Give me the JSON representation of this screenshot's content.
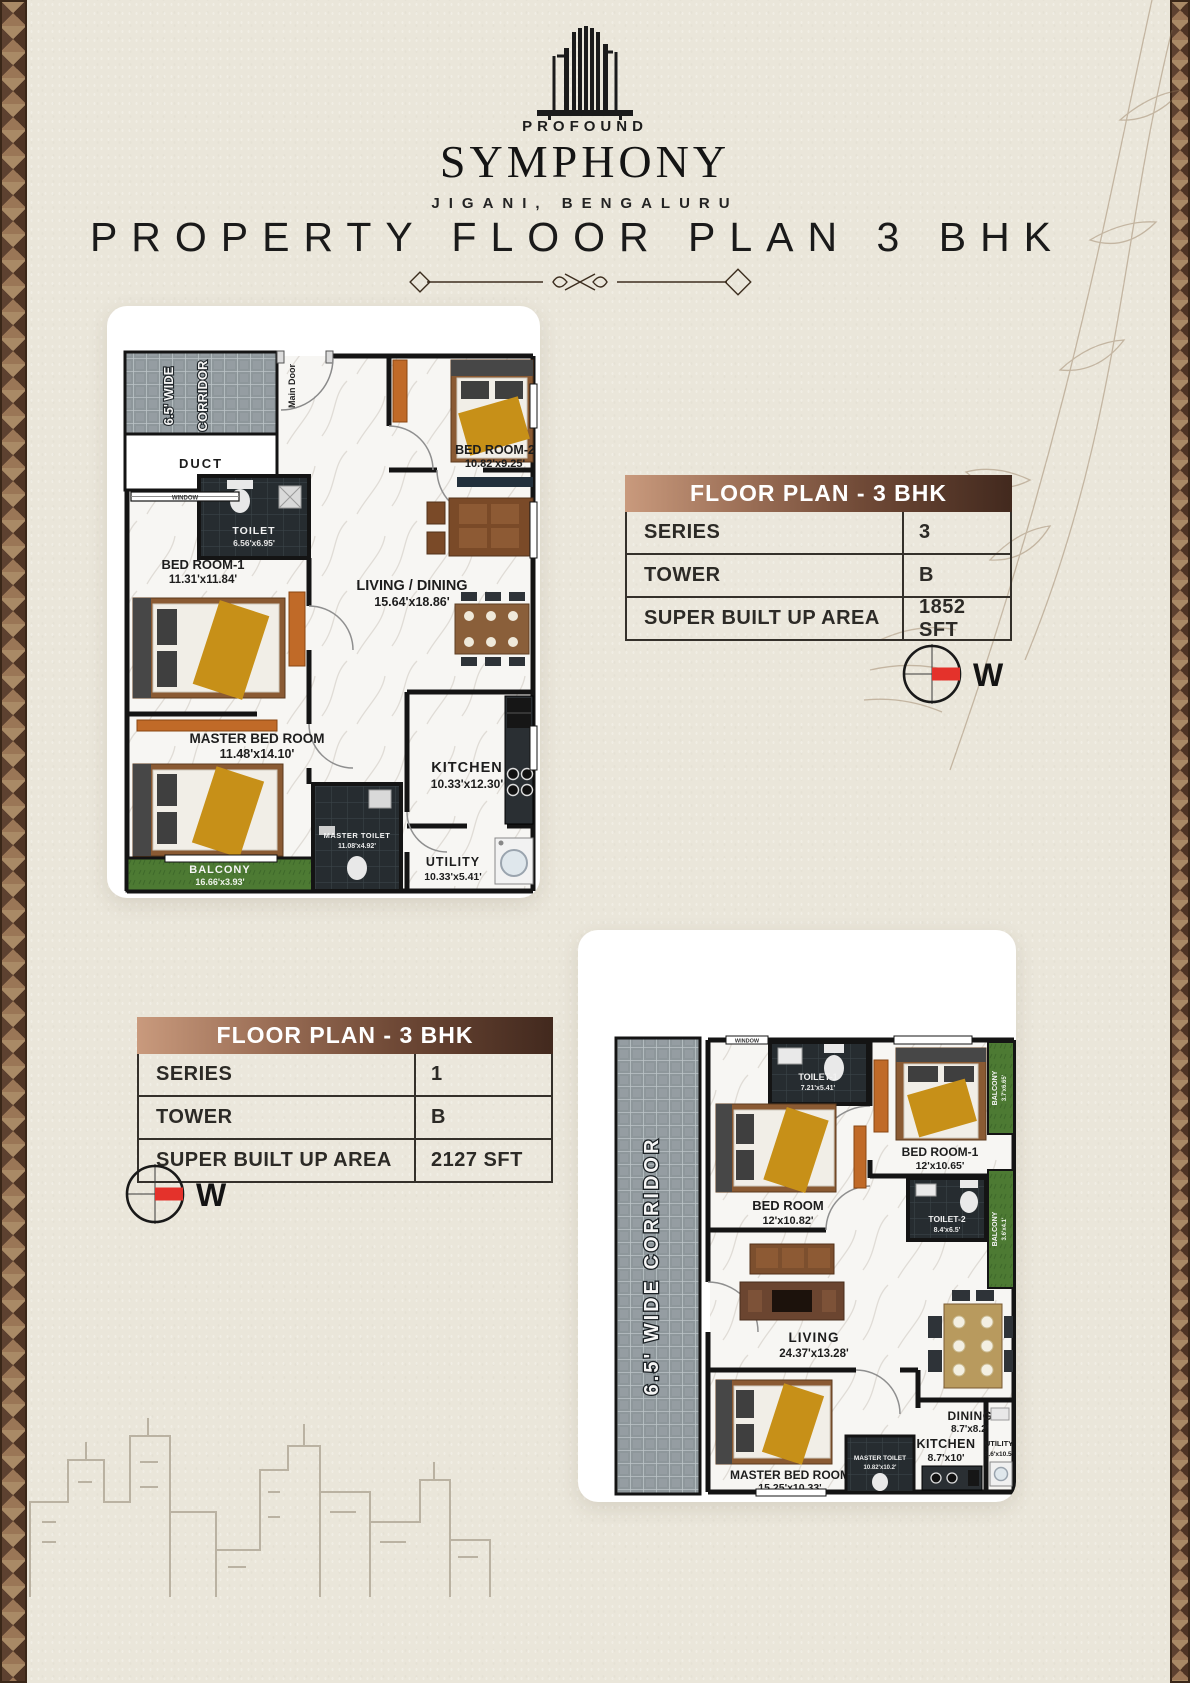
{
  "brand": {
    "top": "PROFOUND",
    "name": "SYMPHONY",
    "location": "JIGANI, BENGALURU"
  },
  "page_title": "PROPERTY FLOOR PLAN 3 BHK",
  "compass": {
    "west": "W"
  },
  "tables": {
    "plan_a": {
      "header": "FLOOR PLAN - 3 BHK",
      "rows": [
        {
          "label": "SERIES",
          "value": "3"
        },
        {
          "label": "TOWER",
          "value": "B"
        },
        {
          "label": "SUPER BUILT UP AREA",
          "value": "1852 SFT"
        }
      ]
    },
    "plan_b": {
      "header": "FLOOR PLAN - 3 BHK",
      "rows": [
        {
          "label": "SERIES",
          "value": "1"
        },
        {
          "label": "TOWER",
          "value": "B"
        },
        {
          "label": "SUPER BUILT UP AREA",
          "value": "2127 SFT"
        }
      ]
    }
  },
  "plan_a": {
    "corridor_line1": "6.5' WIDE",
    "corridor_line2": "CORRIDOR",
    "main_door": "Main Door",
    "duct": "DUCT",
    "window": "WINDOW",
    "rooms": {
      "bedroom2": {
        "name": "BED ROOM-2",
        "dim": "10.82'x9.25'"
      },
      "toilet": {
        "name": "TOILET",
        "dim": "6.56'x6.95'"
      },
      "bedroom1": {
        "name": "BED ROOM-1",
        "dim": "11.31'x11.84'"
      },
      "living": {
        "name": "LIVING / DINING",
        "dim": "15.64'x18.86'"
      },
      "master_bedroom": {
        "name": "MASTER BED ROOM",
        "dim": "11.48'x14.10'"
      },
      "kitchen": {
        "name": "KITCHEN",
        "dim": "10.33'x12.30'"
      },
      "master_toilet": {
        "name": "MASTER TOILET",
        "dim": "11.08'x4.92'"
      },
      "utility": {
        "name": "UTILITY",
        "dim": "10.33'x5.41'"
      },
      "balcony": {
        "name": "BALCONY",
        "dim": "16.66'x3.93'"
      }
    }
  },
  "plan_b": {
    "corridor": "6.5' WIDE CORRIDOR",
    "window": "WINDOW",
    "rooms": {
      "toilet1": {
        "name": "TOILET-1",
        "dim": "7.21'x5.41'"
      },
      "bedroom1": {
        "name": "BED ROOM-1",
        "dim": "12'x10.65'"
      },
      "balcony1": {
        "name": "BALCONY",
        "dim": "3.7'x6.65'"
      },
      "bedroom": {
        "name": "BED ROOM",
        "dim": "12'x10.82'"
      },
      "toilet2": {
        "name": "TOILET-2",
        "dim": "8.4'x6.5'"
      },
      "balcony2": {
        "name": "BALCONY",
        "dim": "3.6'x4.1'"
      },
      "living": {
        "name": "LIVING",
        "dim": "24.37'x13.28'"
      },
      "dining": {
        "name": "DINING",
        "dim": "8.7'x8.2'"
      },
      "kitchen": {
        "name": "KITCHEN",
        "dim": "8.7'x10'"
      },
      "master_bedroom": {
        "name": "MASTER BED ROOM",
        "dim": "15.25'x10.33'"
      },
      "master_toilet": {
        "name": "MASTER TOILET",
        "dim": "10.82'x10.2'"
      },
      "utility": {
        "name": "UTILITY",
        "dim": "3.6'x10.5'"
      }
    }
  },
  "colors": {
    "background": "#eae6da",
    "header_gradient_start": "#c99a7d",
    "header_gradient_end": "#42291e",
    "accent_red": "#e4322b",
    "wall": "#141414",
    "balcony_green": "#4d7a33",
    "toilet_dark": "#262c30",
    "wood": "#8a5a33",
    "gold": "#c79018"
  }
}
